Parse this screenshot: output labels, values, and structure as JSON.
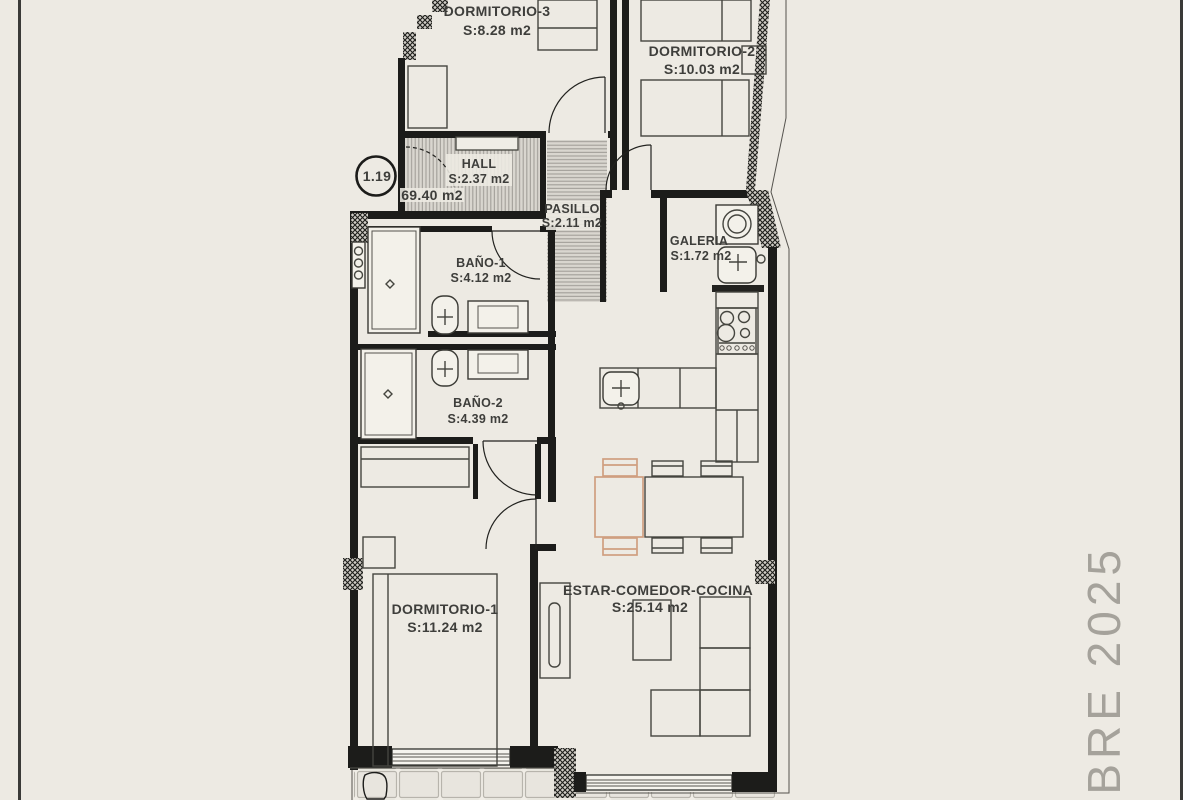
{
  "plan": {
    "unit_number": "1.19",
    "total_area_label": "69.40 m2",
    "watermark": "MBRE 2025",
    "rooms": {
      "dormitorio_3": {
        "name": "DORMITORIO-3",
        "area": "S:8.28 m2"
      },
      "dormitorio_2": {
        "name": "DORMITORIO-2",
        "area": "S:10.03 m2"
      },
      "hall": {
        "name": "HALL",
        "area": "S:2.37 m2"
      },
      "pasillo": {
        "name": "PASILLO",
        "area": "S:2.11 m2"
      },
      "bano_1": {
        "name": "BAÑO-1",
        "area": "S:4.12 m2"
      },
      "galeria": {
        "name": "GALERIA",
        "area": "S:1.72 m2"
      },
      "bano_2": {
        "name": "BAÑO-2",
        "area": "S:4.39 m2"
      },
      "dormitorio_1": {
        "name": "DORMITORIO-1",
        "area": "S:11.24 m2"
      },
      "estar": {
        "name": "ESTAR-COMEDOR-COCINA",
        "area": "S:25.14 m2"
      }
    },
    "colors": {
      "sheet_background": "#edeae3",
      "wall": "#1c1c1a",
      "label_text": "#3e3e3b",
      "accent_tan": "#cf9f80",
      "watermark_gray": "#a5a29b"
    }
  }
}
